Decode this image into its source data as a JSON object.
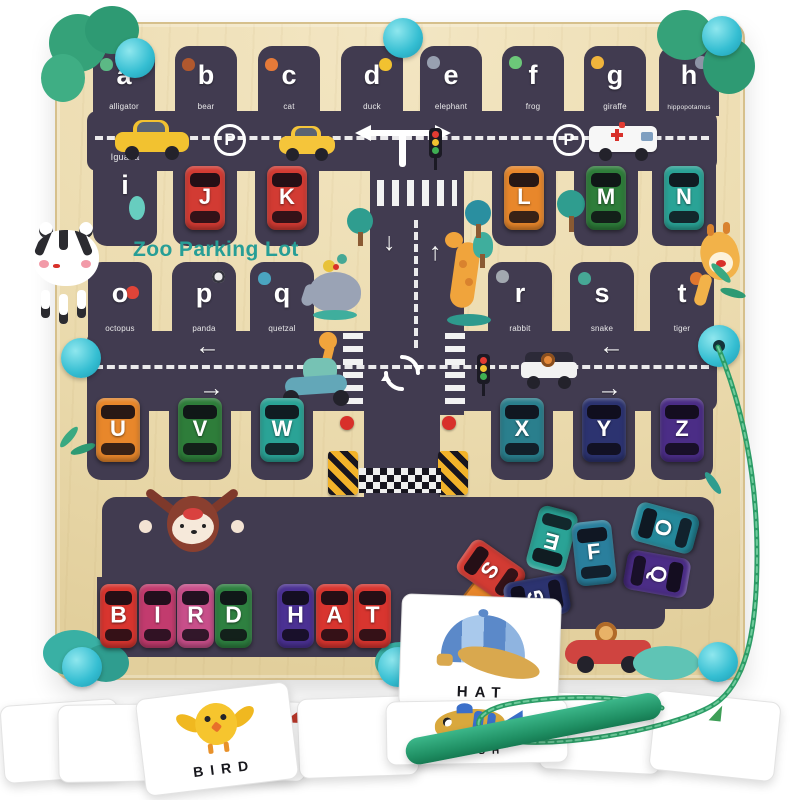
{
  "board": {
    "title": "Zoo Parking Lot",
    "parking_symbol": "P",
    "row1": [
      {
        "letter": "a",
        "animal": "alligator"
      },
      {
        "letter": "b",
        "animal": "bear"
      },
      {
        "letter": "c",
        "animal": "cat"
      },
      {
        "letter": "d",
        "animal": "duck"
      },
      {
        "letter": "e",
        "animal": "elephant"
      },
      {
        "letter": "f",
        "animal": "frog"
      },
      {
        "letter": "g",
        "animal": "giraffe"
      },
      {
        "letter": "h",
        "animal": "hippopotamus"
      }
    ],
    "row2_slot": {
      "letter": "i",
      "animal": "Iguana"
    },
    "row2_cars": [
      {
        "letter": "J",
        "color": "#d23b33"
      },
      {
        "letter": "K",
        "color": "#d23b33"
      },
      {
        "letter": "L",
        "color": "#e8872b"
      },
      {
        "letter": "M",
        "color": "#2e7d3a"
      },
      {
        "letter": "N",
        "color": "#2aa396"
      }
    ],
    "row3": [
      {
        "letter": "o",
        "animal": "octopus"
      },
      {
        "letter": "p",
        "animal": "panda"
      },
      {
        "letter": "q",
        "animal": "quetzal"
      },
      {
        "letter": "r",
        "animal": "rabbit"
      },
      {
        "letter": "s",
        "animal": "snake"
      },
      {
        "letter": "t",
        "animal": "tiger"
      }
    ],
    "row4_cars": [
      {
        "letter": "U",
        "color": "#e8872b"
      },
      {
        "letter": "V",
        "color": "#2e7d3a"
      },
      {
        "letter": "W",
        "color": "#2aa396"
      },
      {
        "letter": "X",
        "color": "#2a7f8d"
      },
      {
        "letter": "Y",
        "color": "#2c3370"
      },
      {
        "letter": "Z",
        "color": "#4b2d86"
      }
    ],
    "loose_tiles": [
      {
        "letter": "S",
        "color": "#d23b33"
      },
      {
        "letter": "E",
        "color": "#2aa396"
      },
      {
        "letter": "F",
        "color": "#2a7f9d"
      },
      {
        "letter": "O",
        "color": "#25889a"
      },
      {
        "letter": "G",
        "color": "#2c3370"
      },
      {
        "letter": "Q",
        "color": "#4b2d86"
      }
    ],
    "bottom_cars": [
      {
        "letter": "B",
        "color": "#d8352f"
      },
      {
        "letter": "I",
        "color": "#c23b6e"
      },
      {
        "letter": "R",
        "color": "#c84f8a"
      },
      {
        "letter": "D",
        "color": "#2e8040"
      },
      {
        "letter": "H",
        "color": "#4b3193"
      },
      {
        "letter": "A",
        "color": "#d8352f"
      },
      {
        "letter": "T",
        "color": "#d8352f"
      }
    ]
  },
  "icons": {
    "arrow_left": "←",
    "arrow_right": "→",
    "arrow_up": "↑",
    "arrow_down": "↓"
  },
  "cards": {
    "bird": {
      "label": "BIRD"
    },
    "fish": {
      "label": "FISH"
    },
    "hat": {
      "label": "HAT"
    }
  },
  "colors": {
    "board_wood": "#ecdcb0",
    "maze": "#413b50",
    "peg": "#35bed2",
    "title": "#279e96",
    "cord": "#2c9c66",
    "pen": "#27a276",
    "hazard_yellow": "#f2b32a"
  }
}
